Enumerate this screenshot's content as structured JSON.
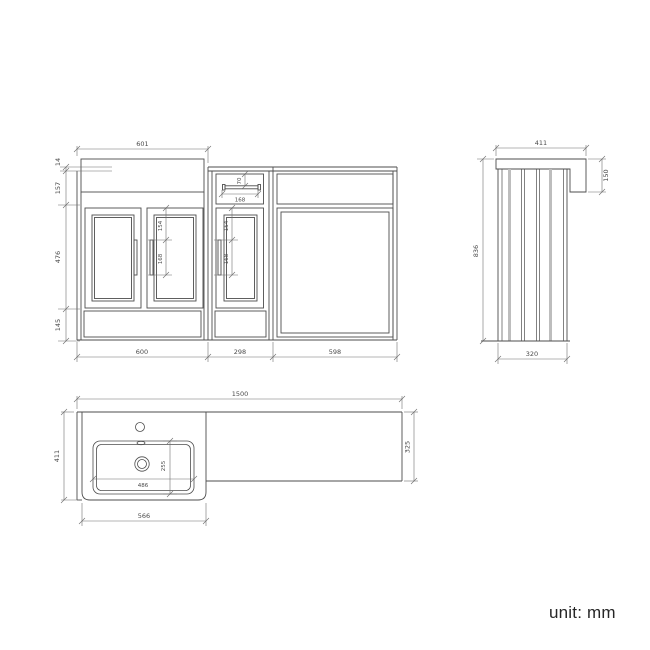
{
  "unit_label": "unit: mm",
  "colors": {
    "line": "#4d4d4d",
    "dim_line": "#6e6e6e",
    "dim_text": "#4a4a4a",
    "panel_shade": "#bdbdbd"
  },
  "front_view": {
    "top_width": "601",
    "height_worktop": "14",
    "height_top_panel": "157",
    "height_doors": "476",
    "height_plinth": "145",
    "width_left_unit": "600",
    "width_middle_unit": "298",
    "width_right_unit": "598",
    "left_handle_offset": "154",
    "left_handle_length": "168",
    "middle_handle_offset": "154",
    "middle_handle_length": "168",
    "drawer_handle_offset": "70",
    "drawer_handle_length": "168"
  },
  "side_view": {
    "top_depth": "411",
    "worktop_drop": "150",
    "height": "836",
    "panel_depth": "320"
  },
  "plan_view": {
    "overall_width": "1500",
    "basin_depth": "411",
    "worktop_depth": "325",
    "basin_width": "566",
    "bowl_width": "486",
    "bowl_depth": "255"
  }
}
